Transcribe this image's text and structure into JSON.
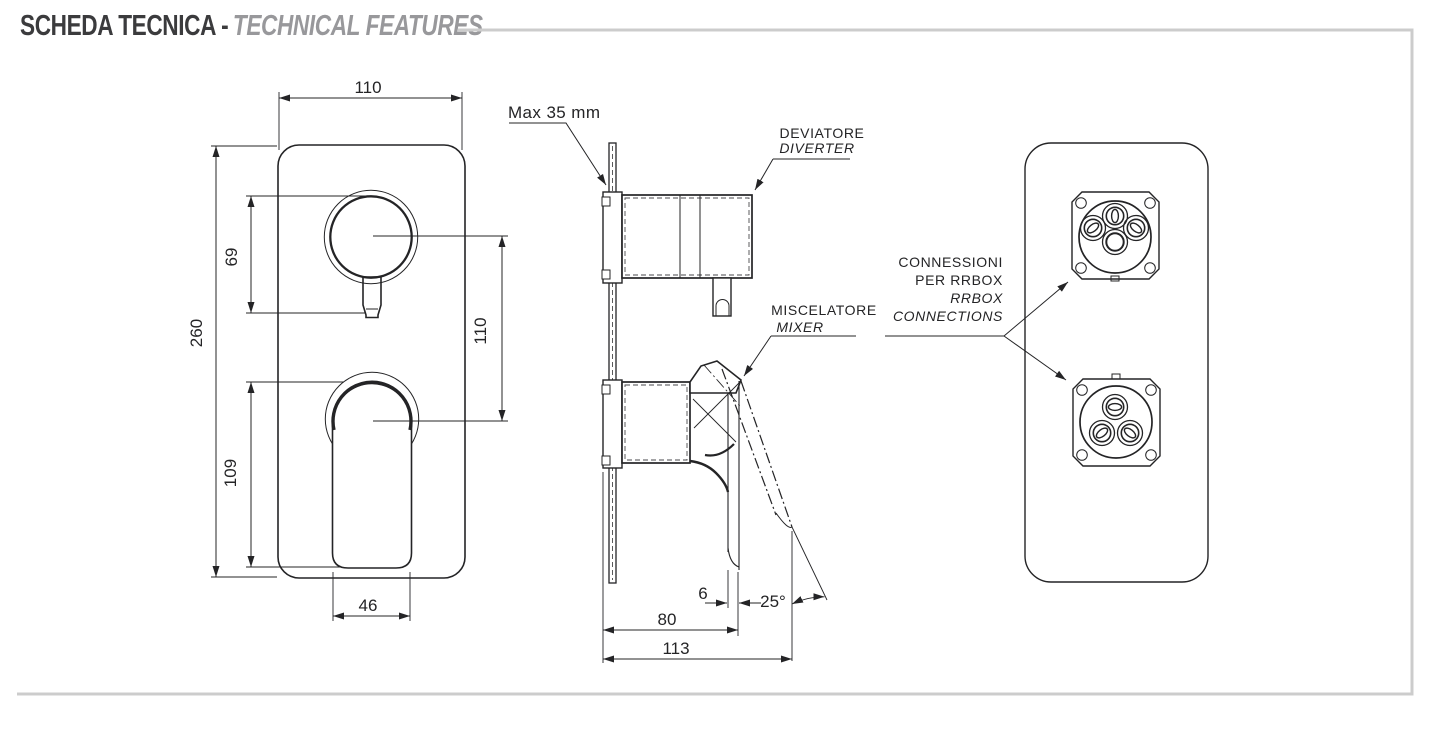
{
  "title": {
    "main": "SCHEDA TECNICA -",
    "accent": "TECHNICAL FEATURES"
  },
  "front_view": {
    "dim_plate_width": "110",
    "dim_diverter_height": "69",
    "dim_overall_height": "260",
    "dim_center_distance": "110",
    "dim_mixer_height": "109",
    "dim_mixer_width": "46"
  },
  "side_view": {
    "wall_note": "Max 35 mm",
    "diverter_label": "DEVIATORE",
    "diverter_label_en": "DIVERTER",
    "mixer_label": "MISCELATORE",
    "mixer_label_en": "MIXER",
    "dim_tip_offset": "6",
    "dim_lever_angle": "25°",
    "dim_body_depth": "80",
    "dim_total_depth": "113"
  },
  "back_view": {
    "connections_label_line1": "CONNESSIONI",
    "connections_label_line2": "PER RRBOX",
    "connections_label_line3": "RRBOX",
    "connections_label_line4": "CONNECTIONS"
  },
  "colors": {
    "line": "#242426",
    "title_dark": "#3b3b3d",
    "title_gray": "#98989b",
    "frame_gray": "#cccccc"
  }
}
